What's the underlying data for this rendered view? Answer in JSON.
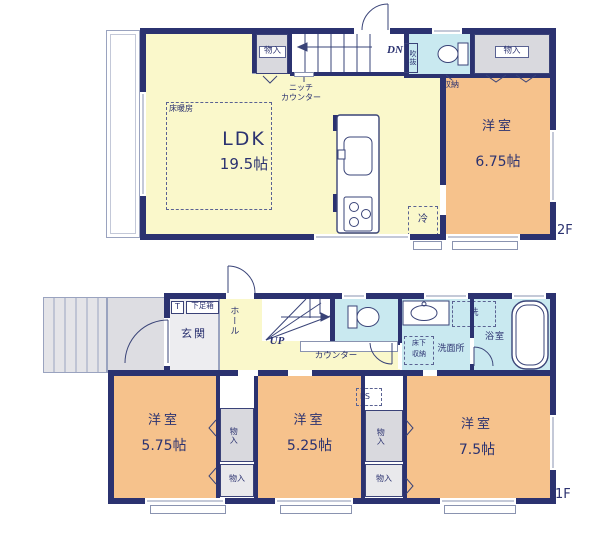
{
  "floor2": {
    "floor_label": "2F",
    "ldk": {
      "name": "LDK",
      "area": "19.5帖"
    },
    "bedroom": {
      "name": "洋室",
      "area": "6.75帖"
    },
    "closet_left": "物入",
    "closet_right": "物入",
    "stairs_down": "DN",
    "void_label": "吹抜",
    "storage": "収納",
    "niche_line1": "ニッチ",
    "niche_line2": "カウンター",
    "floor_heating": "床暖房",
    "fridge": "冷"
  },
  "floor1": {
    "floor_label": "1F",
    "entrance": "玄関",
    "toilet_abbr": "T",
    "shoe_box": "下足箱",
    "hall": "ホール",
    "stairs_up": "UP",
    "counter": "カウンター",
    "underfloor_line1": "床下",
    "underfloor_line2": "収納",
    "washroom": "洗面所",
    "laundry": "洗",
    "bathroom": "浴室",
    "pipe_space": "PS",
    "closet_a": "物入",
    "closet_b": "物入",
    "closet_c": "物入",
    "closet_d": "物入",
    "bedroom_west": {
      "name": "洋室",
      "area": "5.75帖"
    },
    "bedroom_center": {
      "name": "洋室",
      "area": "5.25帖"
    },
    "bedroom_east": {
      "name": "洋室",
      "area": "7.5帖"
    }
  },
  "colors": {
    "wall": "#2b3270",
    "ldk_fill": "#faf8cb",
    "bedroom_fill": "#f6c28c",
    "wet_area_fill": "#c9e9f0",
    "closet_fill": "#d9d9de"
  }
}
